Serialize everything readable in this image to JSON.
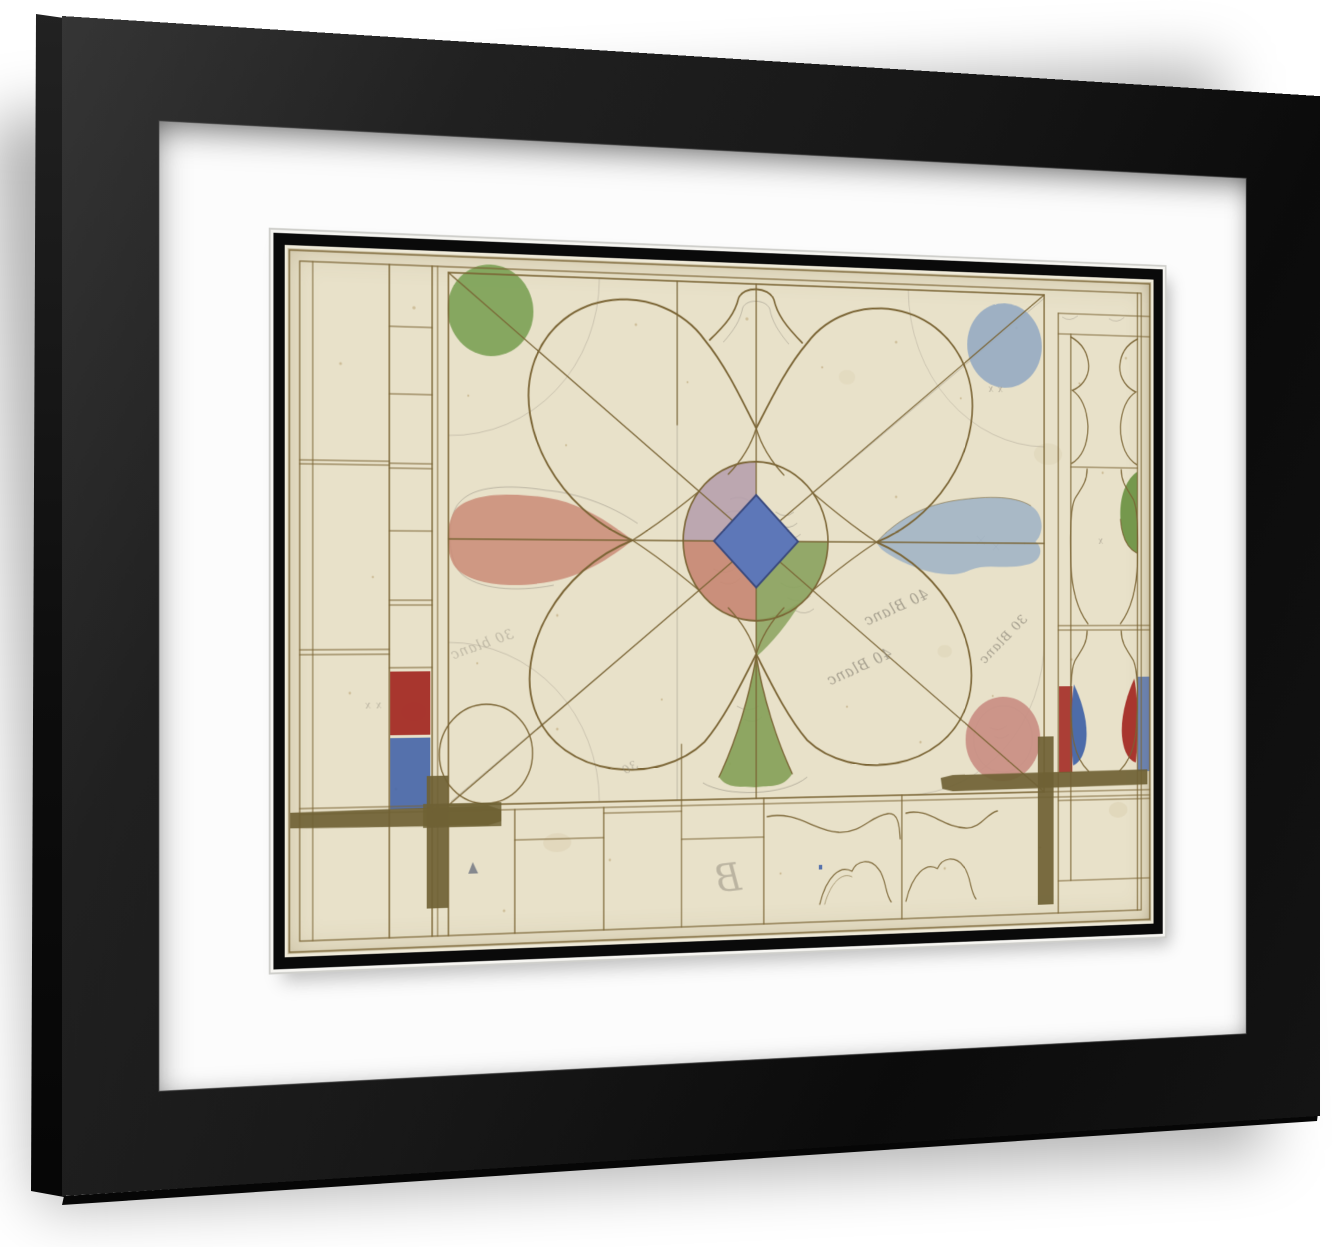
{
  "page": {
    "background_color": "#ffffff"
  },
  "frame": {
    "frame_color": "#181818",
    "frame_highlight": "#353535",
    "side_color": "#0e0e0e",
    "mat_color": "#fcfcfc",
    "fillet_color": "#0a0a0a"
  },
  "artwork": {
    "paper_color": "#e8e1c9",
    "ink_color": "#7a6434",
    "pencil_color": "#8e887b",
    "palette": {
      "mauve": "#b49cab",
      "quad_salmon": "#c68672",
      "quad_green": "#8aa25e",
      "diamond_blue": "#5d77b8",
      "green_circle": "#7da257",
      "blue_circle": "#96abc2",
      "pink_circle": "#c98e83",
      "salmon_blob": "#cb8d79",
      "blue_blob": "#9db1c6",
      "leaf_green": "#85a159",
      "drop_green": "#6f9447",
      "glass_red": "#a42c26",
      "glass_blue": "#4565a8",
      "band_brown": "#6f6134"
    },
    "annotations": [
      {
        "text": "40 Blanc"
      },
      {
        "text": "40 Blanc"
      },
      {
        "text": "30 Blanc"
      },
      {
        "text": "30 blanc"
      },
      {
        "text": "30"
      },
      {
        "text": "B"
      },
      {
        "text": "x x"
      },
      {
        "text": "x"
      },
      {
        "text": "x x"
      }
    ]
  }
}
